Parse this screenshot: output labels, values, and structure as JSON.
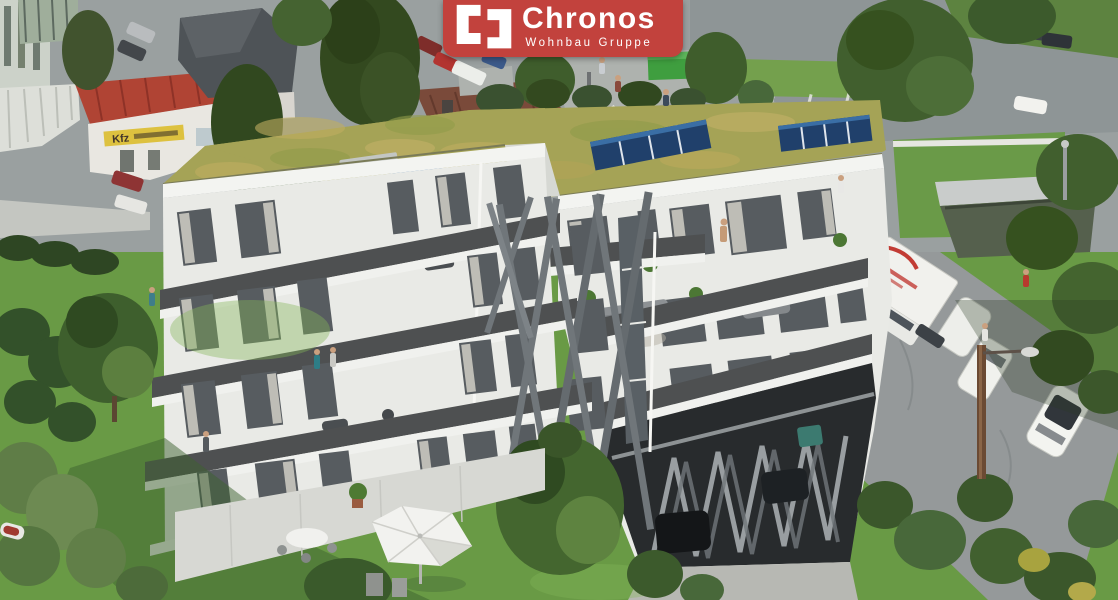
{
  "logo": {
    "brand": "Chronos",
    "subtitle": "Wohnbau Gruppe",
    "icon": "brackets-icon",
    "bg_color": "#c2423d",
    "text_color": "#ffffff"
  },
  "signs": {
    "kfz_sign": "Kfz"
  },
  "palette": {
    "brand-red": "#c2423d",
    "logo-text": "#ffffff",
    "grass": "#699a45",
    "grass-shade": "#4e7736",
    "tree-dark": "#3c5a2c",
    "asphalt": "#9aa0a0",
    "asphalt-dark": "#8e9596",
    "building-white": "#e9eae6",
    "parapet-dark": "#4e5051",
    "roof-green": "#a5a356",
    "solar-blue": "#20406b",
    "red-roof": "#b04434",
    "sign-yellow": "#ddc13f",
    "steel-gray": "#70767a"
  },
  "scene": {
    "type": "aerial architectural rendering",
    "objects": [
      "modern-apartment-building",
      "green-sedum-roof",
      "solar-panel-arrays",
      "staggered-balconies",
      "x-brace-facade",
      "carport-zigzag-columns",
      "roof-terrace-people",
      "garden-lawn",
      "patio-parasol",
      "neighbour-houses",
      "kfz-workshop-sign",
      "box-truck",
      "white-vans",
      "white-suv",
      "parking-lot",
      "street-trees",
      "utility-pole",
      "street-lamp"
    ]
  }
}
